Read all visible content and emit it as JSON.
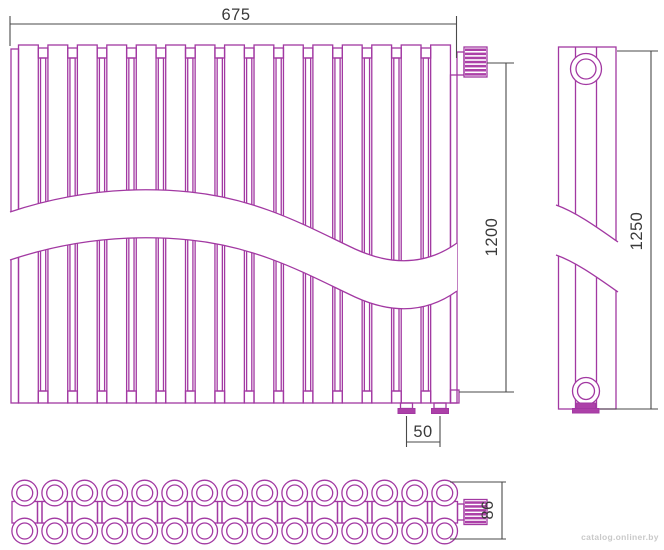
{
  "title": "radiator-technical-drawing",
  "dimensions": {
    "width_mm": "675",
    "height_mm": "1200",
    "overall_height_mm": "1250",
    "connection_pitch_mm": "50",
    "depth_mm": "86"
  },
  "views": {
    "front": {
      "label": "front-view",
      "sections": 15,
      "connectors": 14
    },
    "side": {
      "label": "side-view"
    },
    "bottom": {
      "label": "bottom-view",
      "tube_columns": 15,
      "tube_rows": 2
    }
  },
  "watermark": {
    "text": "catalog.onliner.by"
  },
  "colors": {
    "outline": "#A238A2",
    "accent_fill": "#AC40A8",
    "dimension_line": "#4a4a4a",
    "dimension_text": "#3a3a3a",
    "watermark_text": "#c9c9c9",
    "background": "#ffffff"
  }
}
